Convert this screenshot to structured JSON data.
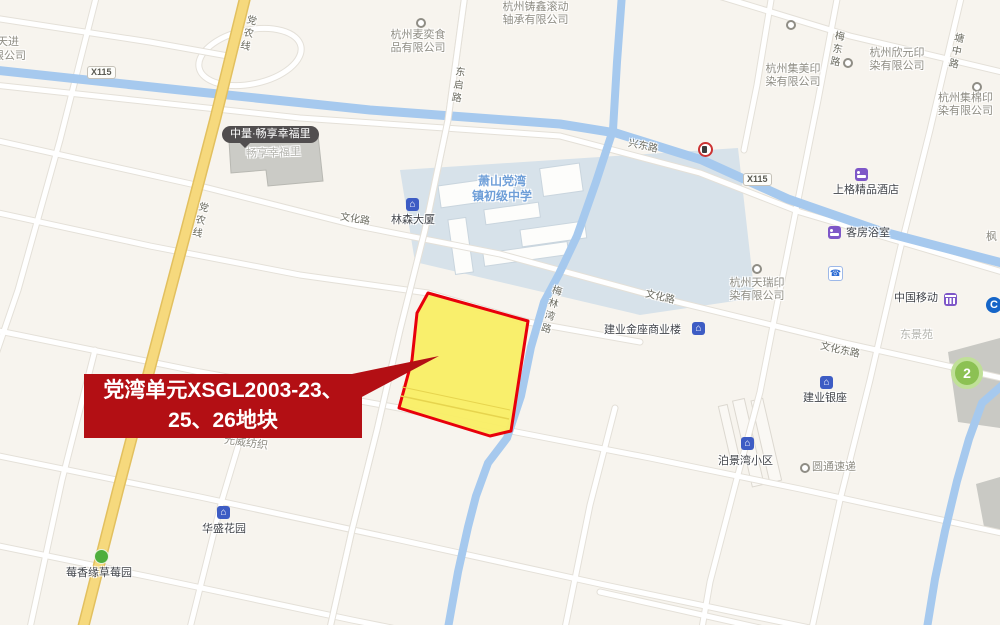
{
  "annotation": {
    "line1": "党湾单元XSGL2003-23、",
    "line2": "25、26地块"
  },
  "roads": {
    "dangnongxian": "党农线",
    "x115": "X115",
    "dongqilu": "东启路",
    "xingdonglu": "兴东路",
    "meidonglu": "梅东路",
    "tangzhonglu": "塘中路",
    "wenhualu": "文化路",
    "wenhuadonglu": "文化东路",
    "meilinwanlu": "梅林湾路"
  },
  "pois": {
    "ruitianjin": {
      "line1": "瑞天进",
      "line2": "有限公司"
    },
    "maiyi": {
      "line1": "杭州麦奕食",
      "line2": "品有限公司"
    },
    "zhuxin": {
      "line1": "杭州铸鑫滚动",
      "line2": "轴承有限公司"
    },
    "jimei": {
      "line1": "杭州集美印",
      "line2": "染有限公司"
    },
    "xinyuan": {
      "line1": "杭州欣元印",
      "line2": "染有限公司"
    },
    "jimian": {
      "line1": "杭州集棉印",
      "line2": "染有限公司"
    },
    "tianrui": {
      "line1": "杭州天瑞印",
      "line2": "染有限公司"
    },
    "school": {
      "line1": "萧山党湾",
      "line2": "镇初级中学"
    },
    "zhongliang_tooltip": "中量·畅享幸福里",
    "changxiang": "畅享幸福里",
    "shangge": "上格精品酒店",
    "kefang": "客房浴室",
    "yidong": "中国移动",
    "dongjingyuan": "东景苑",
    "jianyeyinzuo": "建业银座",
    "jianyejinzuo": "建业金座商业楼",
    "bojingwan": "泊景湾小区",
    "yuantong": "圆通速递",
    "guangwei": "光威纺织",
    "huasheng": "华盛花园",
    "linsen": "林森大厦",
    "meixiangyuan": "莓香缘草莓园",
    "feng": "枫"
  },
  "badges": {
    "metro_line": "2",
    "bank_c": "C"
  },
  "colors": {
    "annotation_red": "#b30f14",
    "parcel_fill": "#f9ee66",
    "parcel_border": "#e8000b",
    "road_yellow": "#f6d97d",
    "water": "#a6c9ee",
    "background": "#f7f4ee"
  }
}
